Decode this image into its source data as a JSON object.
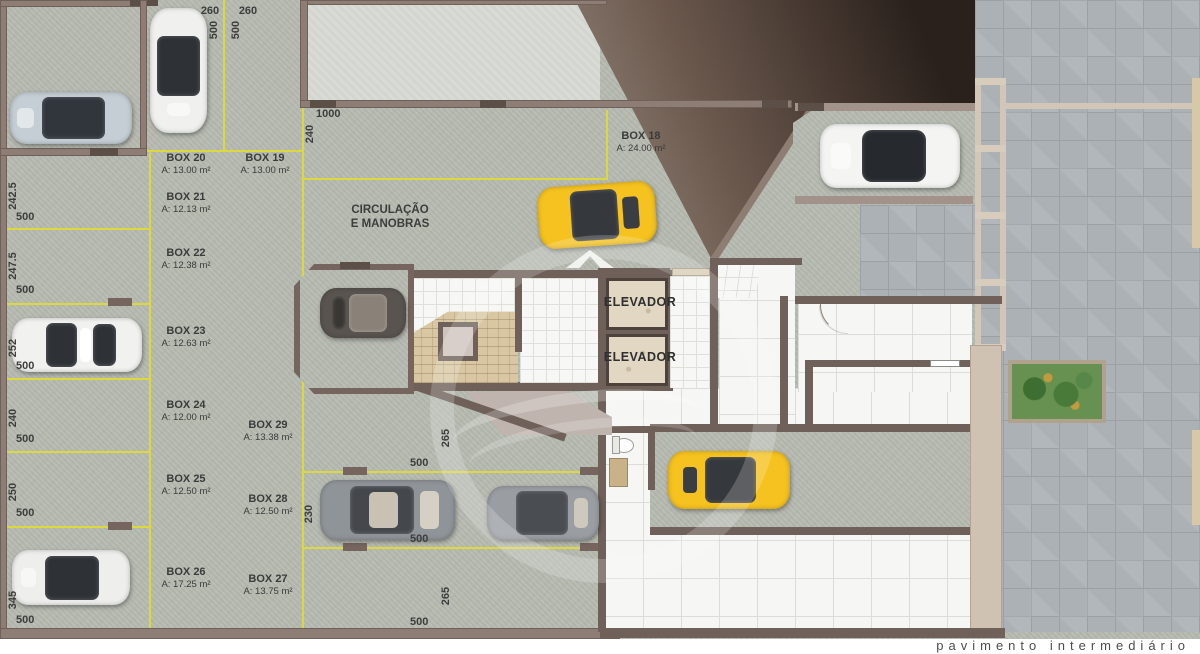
{
  "footer": {
    "title": "pavimento intermediário"
  },
  "labels": {
    "circulation_line1": "CIRCULAÇÃO",
    "circulation_line2": "E MANOBRAS",
    "elevator1": "ELEVADOR",
    "elevator2": "ELEVADOR"
  },
  "boxes": [
    {
      "name": "BOX 18",
      "area": "A: 24.00 m²"
    },
    {
      "name": "BOX 19",
      "area": "A: 13.00 m²"
    },
    {
      "name": "BOX 20",
      "area": "A: 13.00 m²"
    },
    {
      "name": "BOX 21",
      "area": "A: 12.13 m²"
    },
    {
      "name": "BOX 22",
      "area": "A: 12.38 m²"
    },
    {
      "name": "BOX 23",
      "area": "A: 12.63 m²"
    },
    {
      "name": "BOX 24",
      "area": "A: 12.00 m²"
    },
    {
      "name": "BOX 25",
      "area": "A: 12.50 m²"
    },
    {
      "name": "BOX 26",
      "area": "A: 17.25 m²"
    },
    {
      "name": "BOX 27",
      "area": "A: 13.75 m²"
    },
    {
      "name": "BOX 28",
      "area": "A: 12.50 m²"
    },
    {
      "name": "BOX 29",
      "area": "A: 13.38 m²"
    }
  ],
  "dims": {
    "top": [
      {
        "len": "260",
        "dep": "500"
      },
      {
        "len": "260",
        "dep": "500"
      }
    ],
    "left": [
      {
        "len": "242.5",
        "dep": "500"
      },
      {
        "len": "247.5",
        "dep": "500"
      },
      {
        "len": "252",
        "dep": "500"
      },
      {
        "len": "240",
        "dep": "500"
      },
      {
        "len": "250",
        "dep": "500"
      },
      {
        "len": "345",
        "dep": "500"
      }
    ],
    "ramp": {
      "len": "1000",
      "dep": "240"
    },
    "mid": [
      {
        "len": "265",
        "dep": "500"
      },
      {
        "len": "230",
        "dep": "500"
      },
      {
        "len": "265",
        "dep": "500"
      }
    ]
  },
  "colors": {
    "accent_yellow_line": "#ddd83e",
    "car_yellow": "#f5c21f",
    "wall_brown": "#8d7d74",
    "dark_void": "#2a211c"
  }
}
